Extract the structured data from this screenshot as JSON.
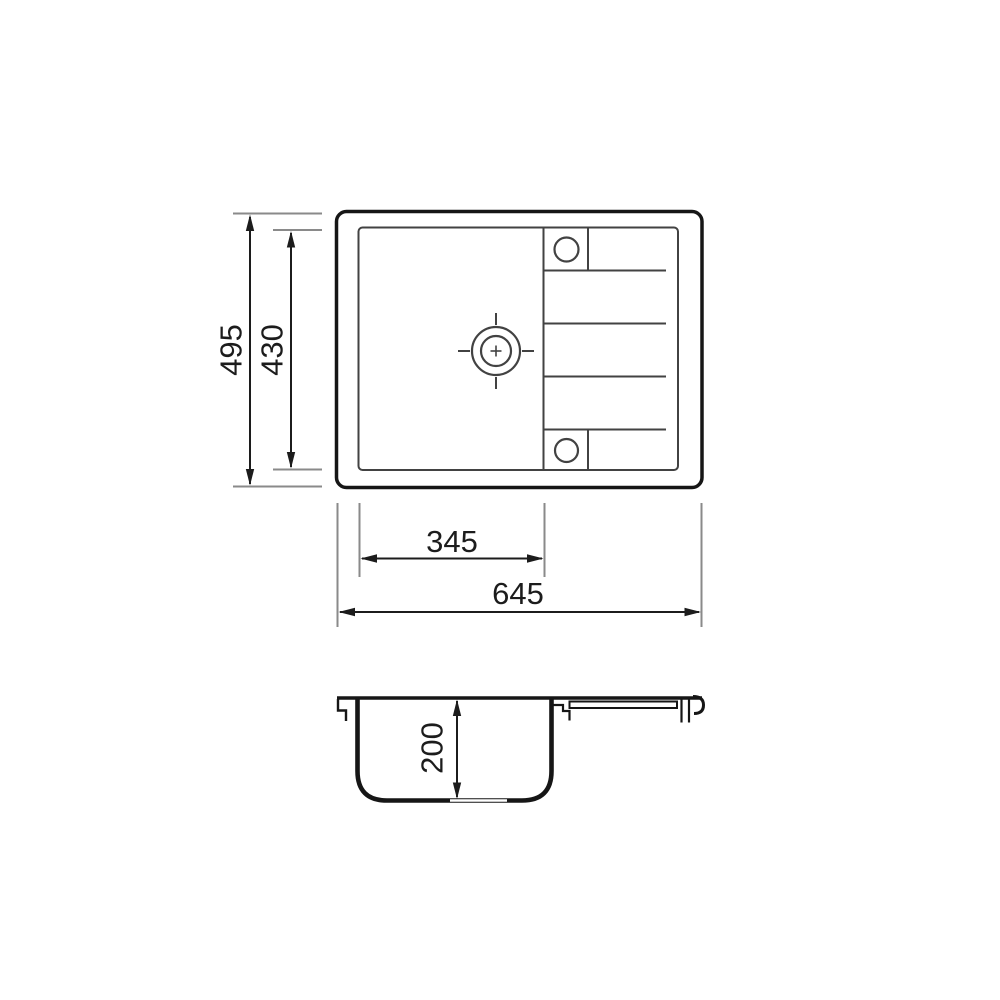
{
  "diagram": {
    "kind": "technical-drawing",
    "subject": "inset kitchen sink with drainer - dimensioned top view and side section view",
    "dimensions": {
      "overall_height": {
        "label": "495",
        "value": 495
      },
      "inner_height": {
        "label": "430",
        "value": 430
      },
      "bowl_width": {
        "label": "345",
        "value": 345
      },
      "overall_width": {
        "label": "645",
        "value": 645
      },
      "bowl_depth": {
        "label": "200",
        "value": 200
      }
    },
    "colors": {
      "outline": "#161616",
      "inner_line": "#424242",
      "dimension_line": "#1c1c1c",
      "extension_line": "#8a8a8a",
      "background": "#ffffff"
    }
  }
}
